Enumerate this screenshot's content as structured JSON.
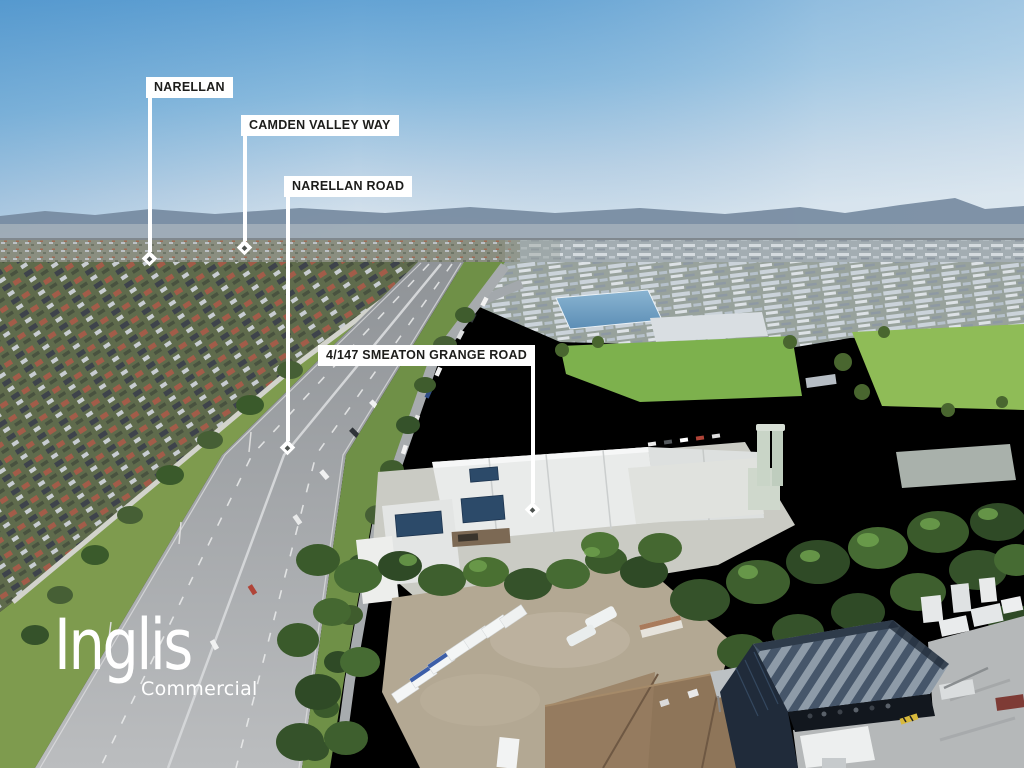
{
  "photo": {
    "description": "Aerial drone photograph of an industrial suburb with a divided arterial road, suburban houses, warehouses, green fields and dense trees under a clear blue sky"
  },
  "callouts": [
    {
      "id": "narellan",
      "label": "NARELLAN"
    },
    {
      "id": "camden-valley-way",
      "label": "CAMDEN VALLEY WAY"
    },
    {
      "id": "narellan-road",
      "label": "NARELLAN ROAD"
    },
    {
      "id": "smeaton-grange",
      "label": "4/147 SMEATON GRANGE ROAD"
    }
  ],
  "logo": {
    "brand": "Inglis",
    "division": "Commercial"
  },
  "colors": {
    "label_bg": "#FFFFFF",
    "label_text": "#1D1D1B",
    "connector_white": "#FFFFFF",
    "logo_white": "#FFFFFF",
    "sky_top": "#5C9ED2",
    "sky_horizon": "#DCE6EE",
    "grass_green": "#7DB14D",
    "road_gray": "#A9ACAF",
    "tree_green": "#3E5F2E",
    "shed_navy": "#202B3A"
  }
}
